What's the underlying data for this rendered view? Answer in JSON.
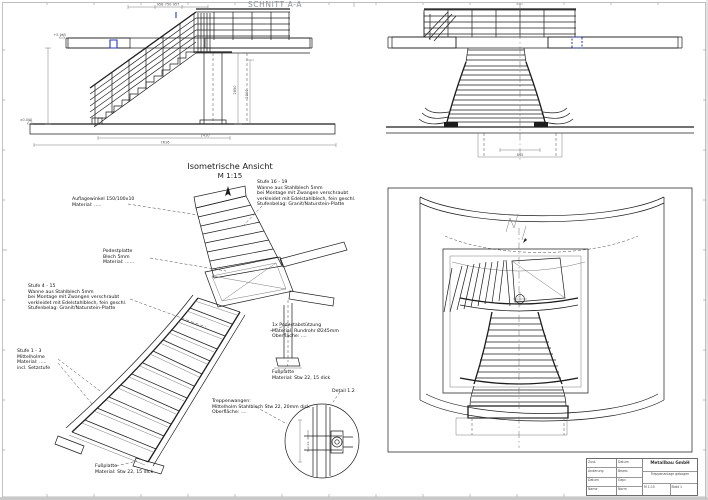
{
  "section": {
    "title": "SCHNITT A-A",
    "dims_top": "958   750   957",
    "dim_right_a": "2850",
    "dim_right_b": "2100",
    "dim_bottom_a": "1410",
    "dim_bottom_b": "7616",
    "level_top": "+5.145",
    "level_bottom": "±0.000"
  },
  "front": {
    "dim_bottom": "845"
  },
  "iso": {
    "title": "Isometrische Ansicht",
    "scale": "M 1:15",
    "annotations": {
      "auflagewinkel": "Auflagewinkel 150/100x10\nMaterial: .....",
      "podestplatte": "Podestplatte\nBlech 5mm\nMaterial: ......",
      "stufe_16_19": "Stufe 16 - 19\nWanne aus Stahlblech 5mm\nbei Montage mit Zwangen verschraubt\nverkleidet mit Edelstahlblech, fein geschl.\nStufenbelag: Granit/Naturstein-Platte",
      "stufe_4_15": "Stufe 4 - 15\nWanne aus Stahlblech 5mm\nbei Montage mit Zwangen verschraubt\nverkleidet mit Edelstahlblech, fein geschl.\nStufenbelag: Granit/Naturstein-Platte",
      "stufe_1_3": "Stufe 1 - 3\nMittelholme\nMaterial: .....\nincl. Setzstufe",
      "podestabstuetzung": "1x Podestabstützung\nMaterial: Rundrohr Ø245mm\nOberfläche: ....",
      "fussplatte_stuetze": "Fußplatte\nMaterial: Stw 22, 15 dick",
      "treppenwangen": "Treppenwangen:\nMittelholm Stahlblech Stw 22, 20mm dick\nOberfläche: ....",
      "fussplatte_antritt": "Fußplatte\nMaterial: Stw 22, 15 dick"
    }
  },
  "detail": {
    "label": "Detail 1.2",
    "note": "Stw 22, 20mm"
  },
  "titleblock": {
    "c1r1": "Zust.",
    "c1r2": "Änderung",
    "c1r3": "Datum",
    "c1r4": "Name",
    "c2r1": "Datum",
    "c2r2": "Bearb.",
    "c2r3": "Gepr.",
    "c2r4": "Norm",
    "company": "Metallbau GmbH",
    "project": "Treppenanlage gebogen",
    "scale": "M 1:15",
    "sheet_no": "Blatt 1"
  }
}
